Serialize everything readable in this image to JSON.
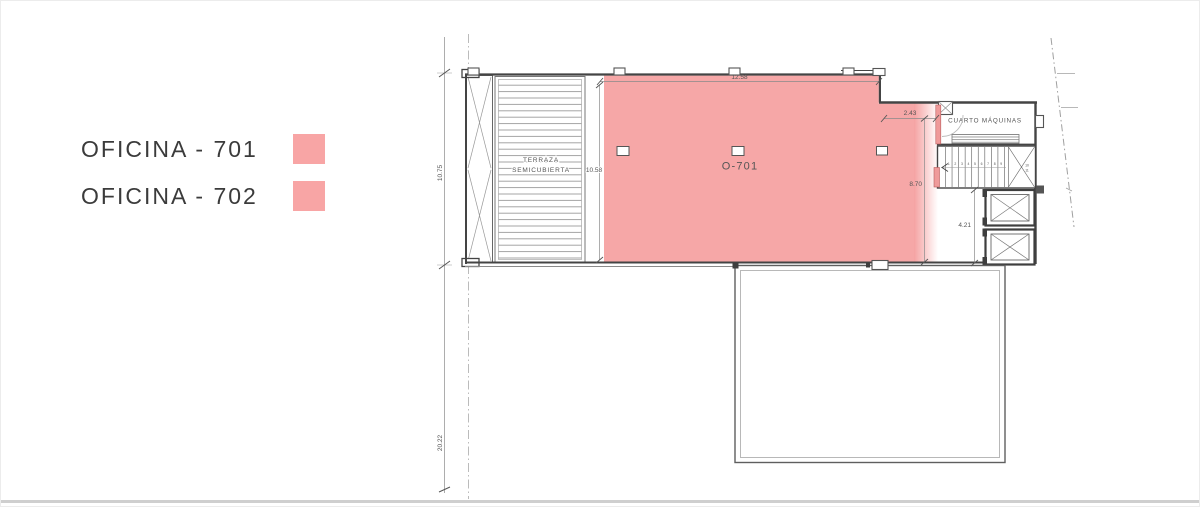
{
  "legend": {
    "items": [
      {
        "label": "OFICINA - 701",
        "color": "#f8a5a5"
      },
      {
        "label": "OFICINA - 702",
        "color": "#f8a5a5"
      }
    ]
  },
  "plan": {
    "labels": {
      "office": "O-701",
      "terrace_line1": "TERRAZA",
      "terrace_line2": "SEMICUBIERTA",
      "machine_room": "CUARTO MÁQUINAS"
    },
    "dimensions": {
      "top_width": "12.58",
      "notch_width": "2.43",
      "terrace_height": "10.58",
      "core_height": "8.70",
      "elevator_height": "4.21",
      "left_upper_height": "10.75",
      "left_lower_height": "20.22"
    },
    "stairs": {
      "tread_count": 10,
      "step_labels": [
        "1",
        "2",
        "3",
        "4",
        "5",
        "6",
        "7",
        "8",
        "9"
      ],
      "landing_labels": [
        "10",
        "11"
      ]
    },
    "colors": {
      "highlight": "#f5a2a2",
      "highlight_wall": "#ef9a9a",
      "office_label": "#c18e91",
      "wall": "#444444",
      "dim_line": "#8a8a8a",
      "dim_text": "#555555"
    }
  }
}
